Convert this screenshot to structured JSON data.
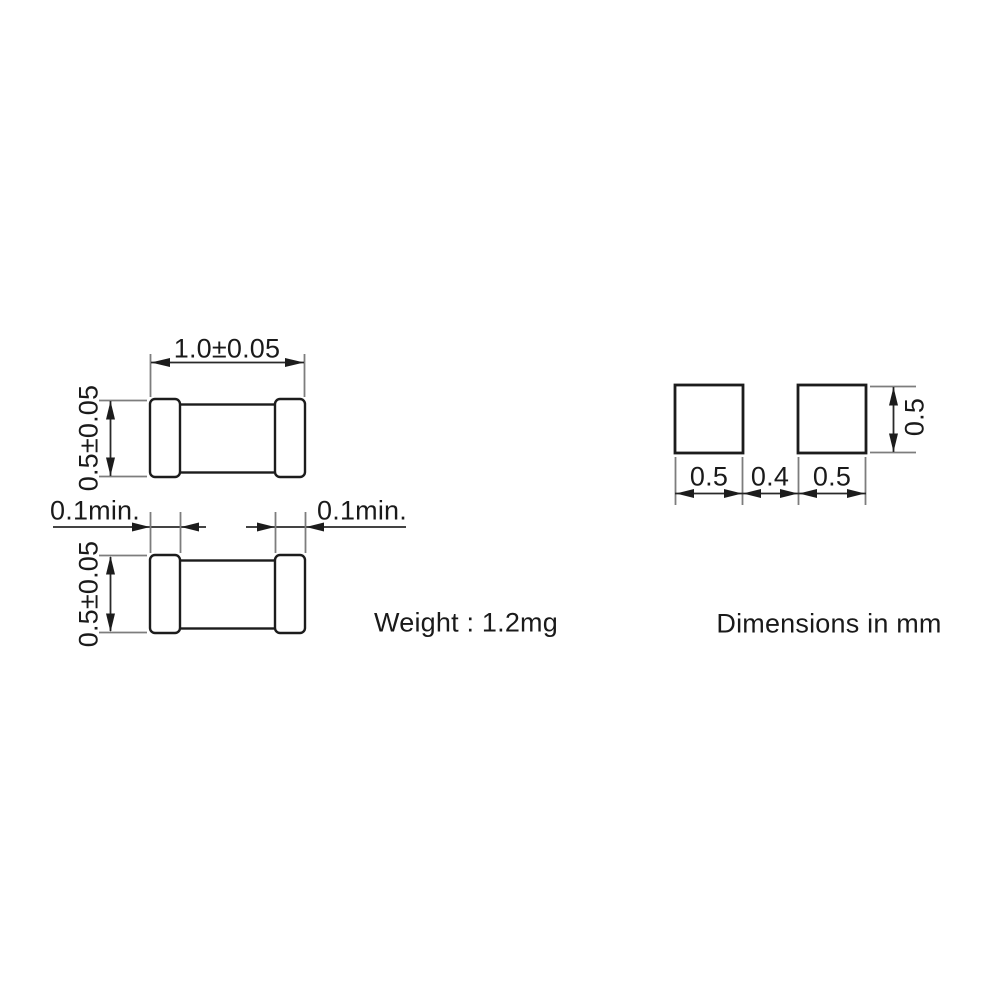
{
  "drawing": {
    "top_view": {
      "length_dim": "1.0±0.05",
      "height_dim": "0.5±0.05"
    },
    "bottom_view": {
      "terminal_band_left_dim": "0.1min.",
      "terminal_band_right_dim": "0.1min.",
      "height_dim": "0.5±0.05"
    },
    "weight_note": "Weight : 1.2mg",
    "land_pattern": {
      "pad_left_width_dim": "0.5",
      "pad_gap_dim": "0.4",
      "pad_right_width_dim": "0.5",
      "pad_height_dim": "0.5"
    },
    "units_note": "Dimensions in mm",
    "colors": {
      "outline": "#1c1c1c",
      "dimension_line": "#2a2a2a",
      "extension_line": "#7d7d7d",
      "text": "#1a1a1a",
      "background": "#ffffff"
    }
  }
}
